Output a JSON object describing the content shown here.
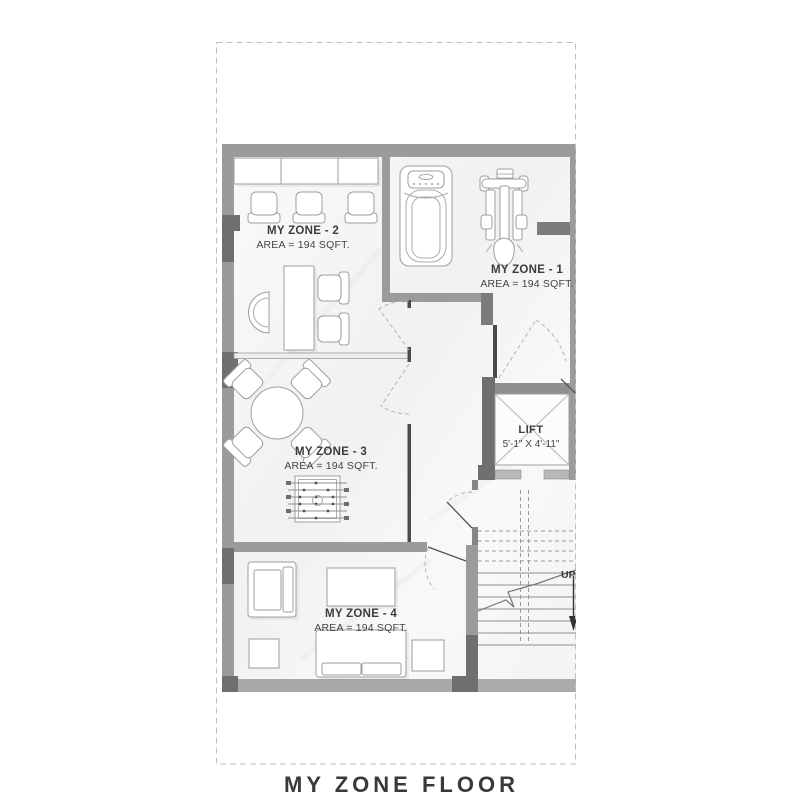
{
  "page": {
    "title": "MY ZONE FLOOR"
  },
  "zones": [
    {
      "name": "MY ZONE - 1",
      "area": "AREA = 194 SQFT."
    },
    {
      "name": "MY ZONE - 2",
      "area": "AREA = 194 SQFT."
    },
    {
      "name": "MY ZONE - 3",
      "area": "AREA = 194 SQFT."
    },
    {
      "name": "MY ZONE - 4",
      "area": "AREA = 194 SQFT."
    }
  ],
  "lift": {
    "label": "LIFT",
    "dimensions": "5'-1\" X 4'-11\""
  },
  "stairs": {
    "direction": "UP"
  },
  "colors": {
    "wall": "#9b9b9b",
    "wall_dark": "#6f6f6f",
    "wall_light": "#a9a9a9",
    "thin_wall": "#4a4a4a",
    "floor": "#f8f8f8",
    "text": "#3c3c3c",
    "dashed_border": "#bfbfbf"
  }
}
